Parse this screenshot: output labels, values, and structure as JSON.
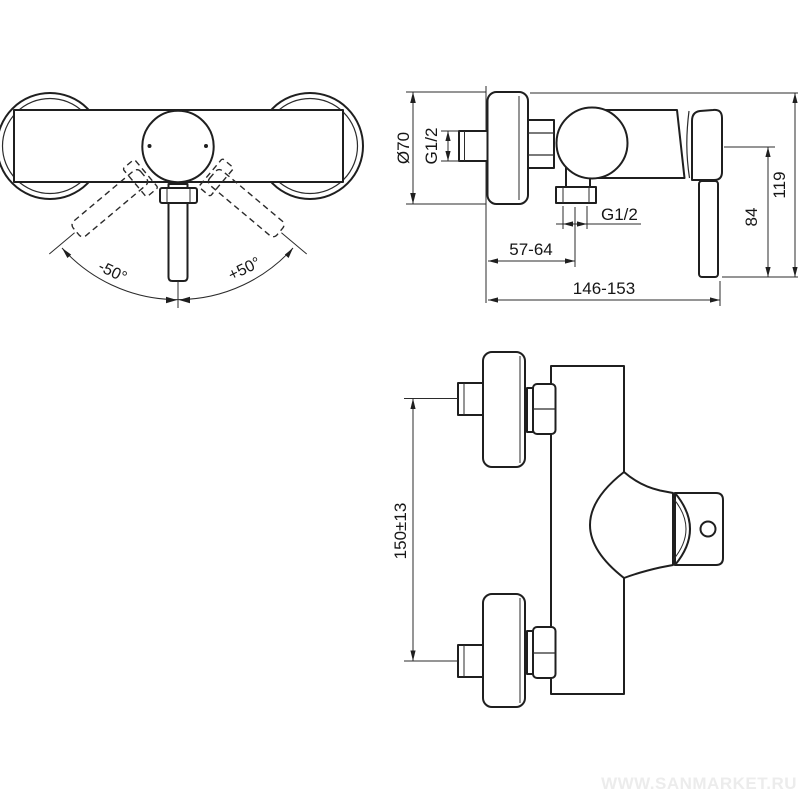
{
  "document": {
    "type": "technical-dimension-drawing",
    "subject": "wall-mounted single-lever shower mixer, three orthographic views"
  },
  "colors": {
    "background": "#ffffff",
    "line": "#1f1f1f",
    "dimension_line": "#2b2b2b",
    "watermark": "#ececec"
  },
  "front_view": {
    "description": "front view with handle swing range",
    "angle_left": "-50°",
    "angle_right": "+50°"
  },
  "side_view": {
    "description": "side view with mounting dimensions (mm)",
    "flange_diameter": "Ø70",
    "inlet_thread": "G1/2",
    "outlet_thread": "G1/2",
    "wall_to_outlet": "57-64",
    "overall_depth": "146-153",
    "handle_height": "84",
    "overall_height": "119"
  },
  "top_view": {
    "description": "top view with inlet spacing (mm)",
    "inlet_spacing": "150±13"
  },
  "watermark": {
    "text": "WWW.SANMARKET.RU"
  }
}
